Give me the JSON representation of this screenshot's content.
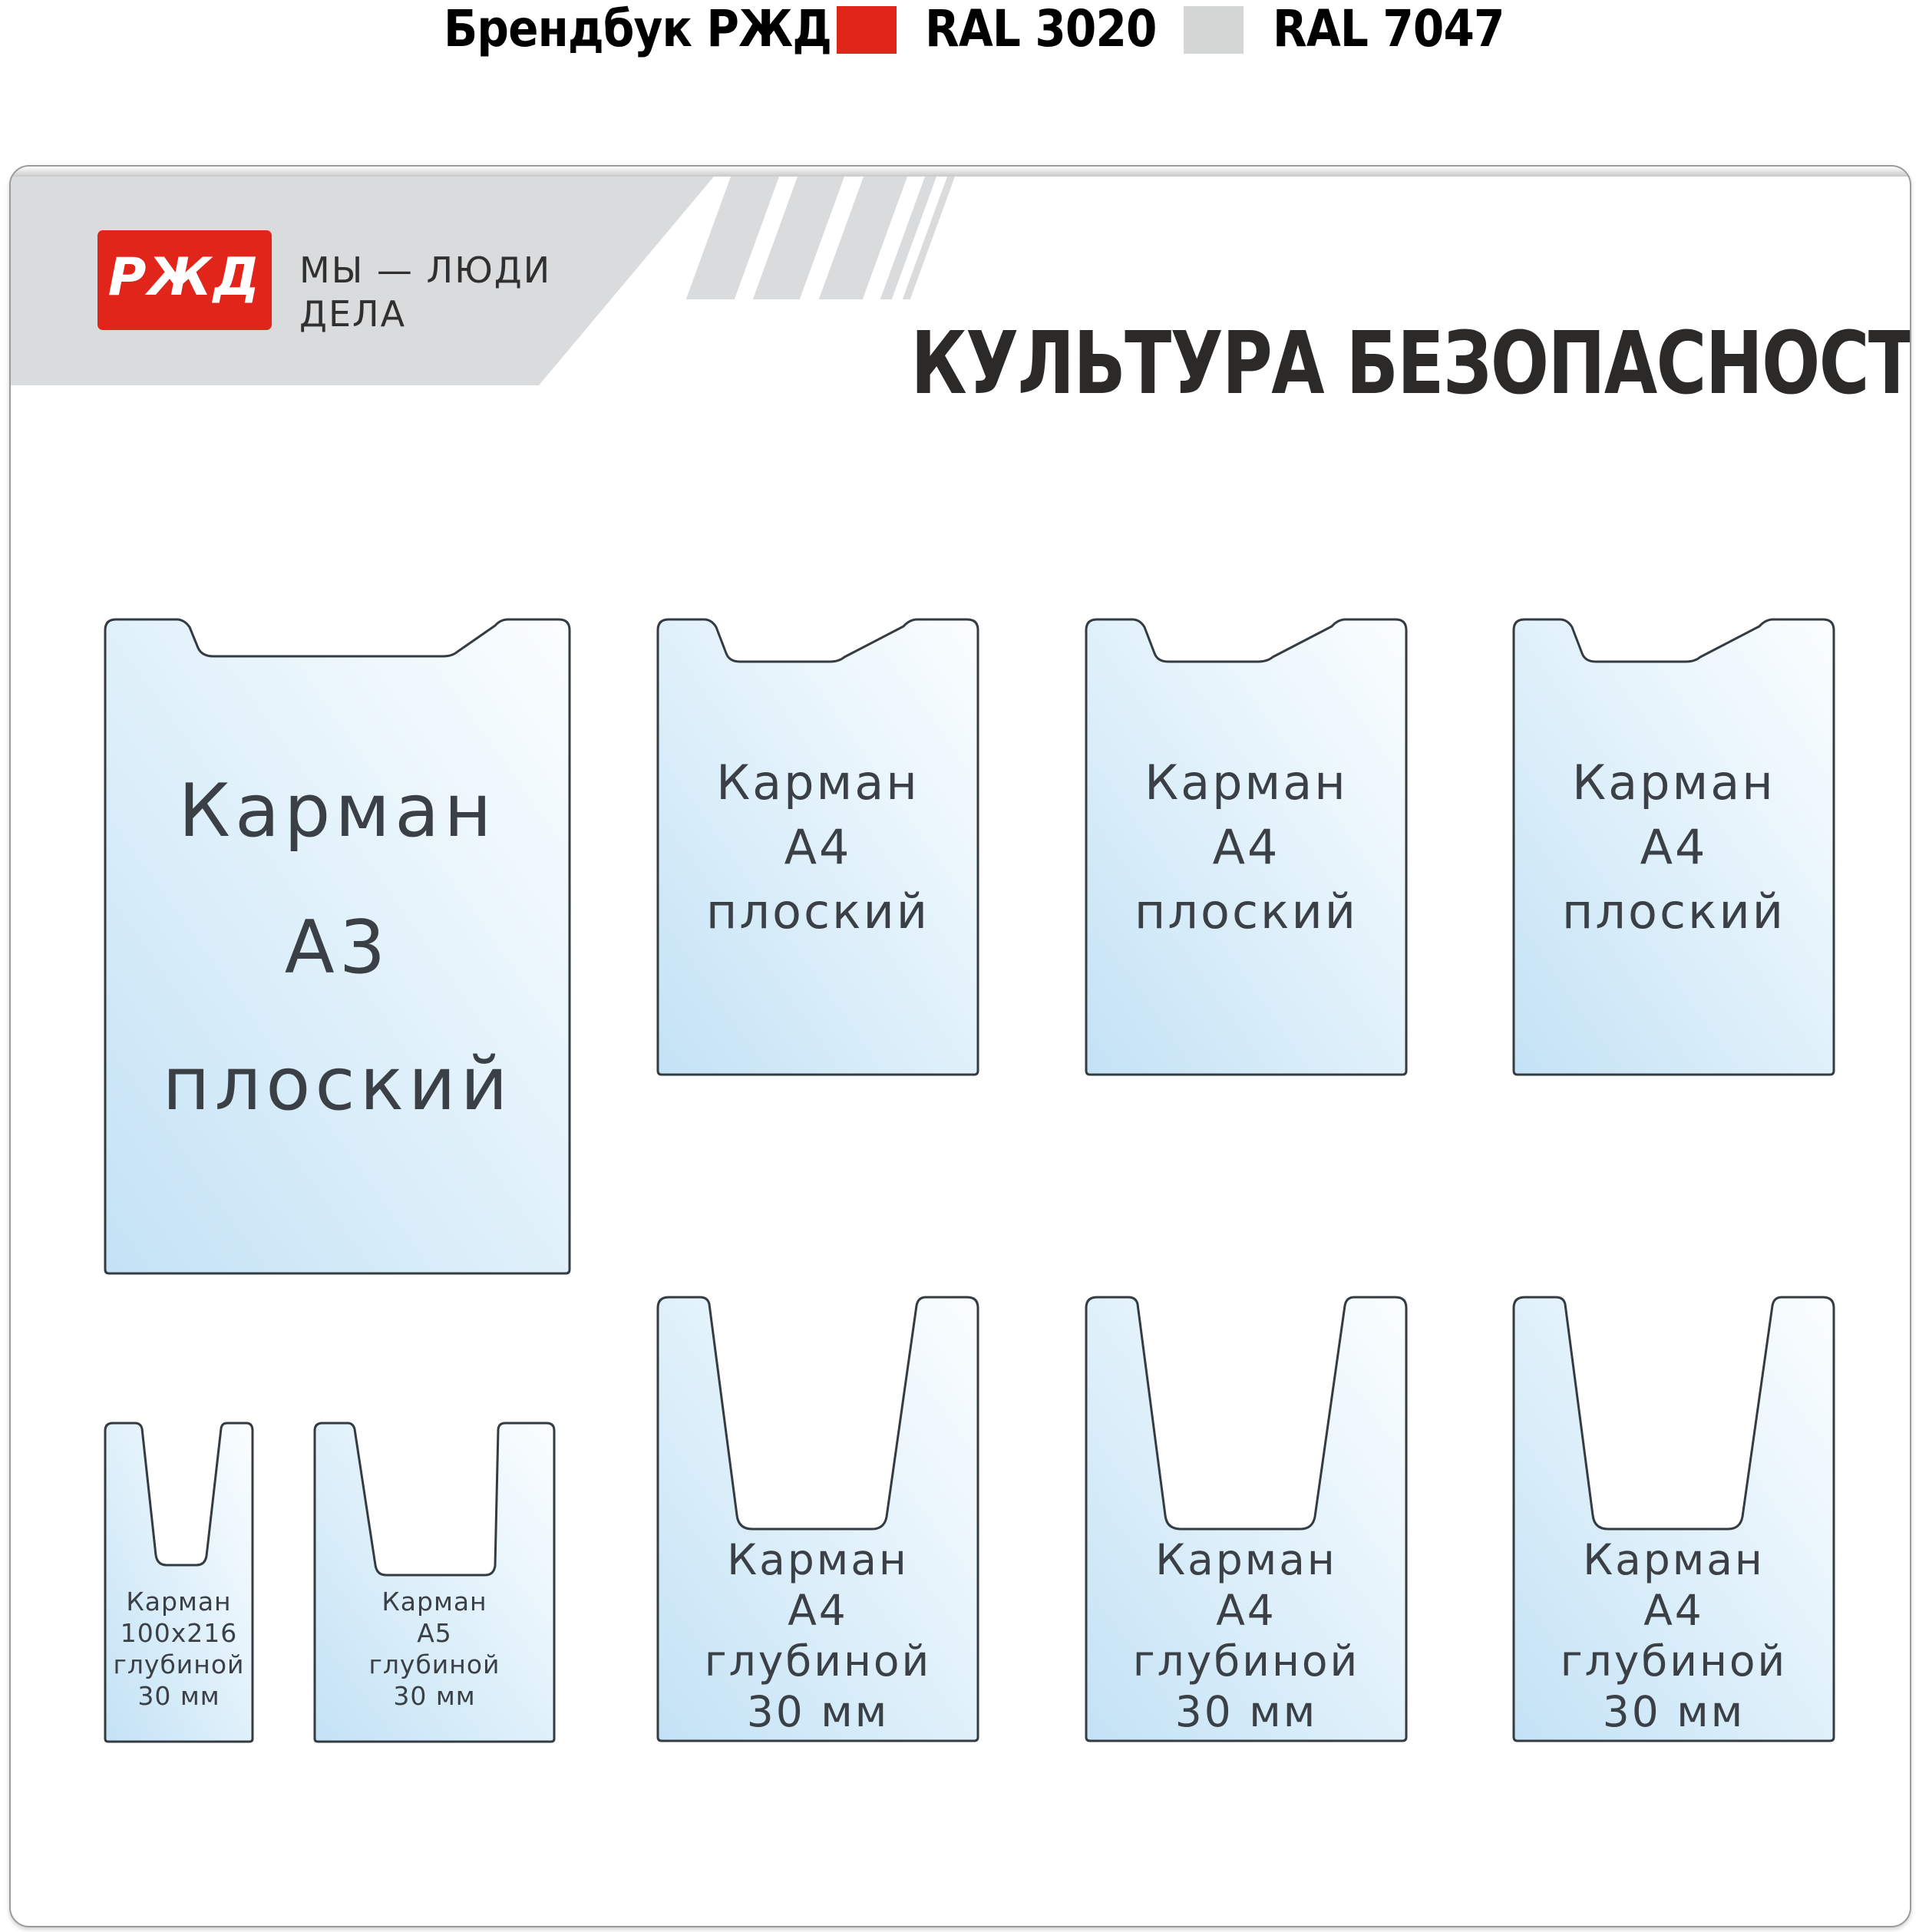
{
  "theme": {
    "accent-red": "#e1251b",
    "band-gray": "#dadbdc",
    "swatch-gray": "#d5d6d6",
    "outline-dark": "#343b41",
    "pocket-blue": "#c3e2f5",
    "pocket-mid": "#e3f2fb",
    "pocket-white": "#fbfeff",
    "text-label": "#3b4046"
  },
  "legend": {
    "title": "Брендбук РЖД",
    "swatches": [
      {
        "label": "RAL 3020",
        "color": "#e1251b"
      },
      {
        "label": "RAL 7047",
        "color": "#d5d6d6"
      }
    ]
  },
  "board": {
    "logo_text": "РЖД",
    "tagline": [
      "МЫ — ЛЮДИ",
      "ДЕЛА"
    ],
    "title": "КУЛЬТУРА БЕЗОПАСНОСТИ"
  },
  "pockets": [
    {
      "id": "a3-flat",
      "lines": [
        "Карман",
        "А3",
        "плоский"
      ]
    },
    {
      "id": "a4-flat-1",
      "lines": [
        "Карман",
        "А4",
        "плоский"
      ]
    },
    {
      "id": "a4-flat-2",
      "lines": [
        "Карман",
        "А4",
        "плоский"
      ]
    },
    {
      "id": "a4-flat-3",
      "lines": [
        "Карман",
        "А4",
        "плоский"
      ]
    },
    {
      "id": "p100x216-deep",
      "lines": [
        "Карман",
        "100x216",
        "глубиной",
        "30 мм"
      ]
    },
    {
      "id": "a5-deep",
      "lines": [
        "Карман",
        "А5",
        "глубиной",
        "30 мм"
      ]
    },
    {
      "id": "a4-deep-1",
      "lines": [
        "Карман",
        "А4",
        "глубиной",
        "30 мм"
      ]
    },
    {
      "id": "a4-deep-2",
      "lines": [
        "Карман",
        "А4",
        "глубиной",
        "30 мм"
      ]
    },
    {
      "id": "a4-deep-3",
      "lines": [
        "Карман",
        "А4",
        "глубиной",
        "30 мм"
      ]
    }
  ]
}
